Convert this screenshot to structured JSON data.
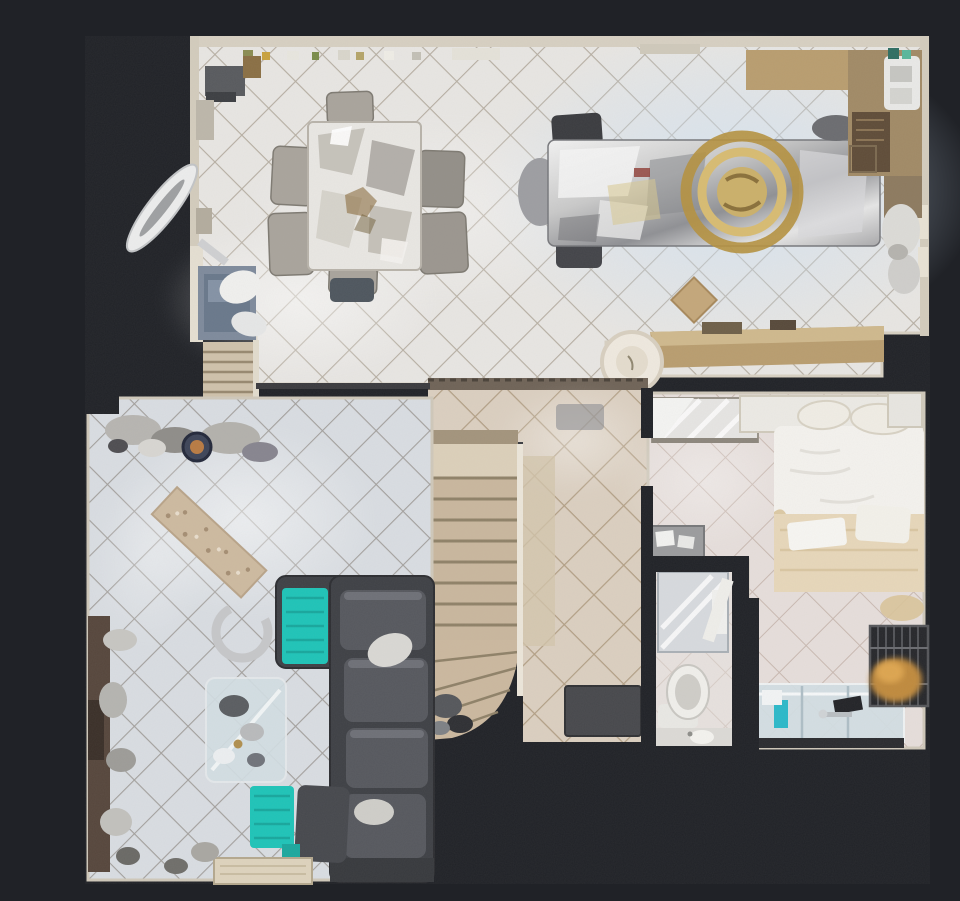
{
  "app": {
    "name": "3d-tour-floorplan-viewer",
    "view": "top-down dollhouse floor plan",
    "floor": "main level"
  },
  "palette": {
    "background": "#202227",
    "wall_beige": "#d7d0c2",
    "tile_kitchen": "#e8e6e3",
    "tile_living": "#d9dde2",
    "tile_hall": "#dbcfc0",
    "tile_bedroom": "#e6dedb",
    "stair_carpet": "#c9b79e",
    "teal_blanket": "#1ec4b8",
    "sofa_dark": "#3e4045",
    "gold_chandelier": "#b5913f",
    "counter_tan": "#b99d6f",
    "cabinet_brown": "#a18a66",
    "entry_rug_blue": "#7e8a9c",
    "mosaic_runner": "#cdbaa0",
    "door_mat": "#47484c",
    "bed_white": "#f4f2ee",
    "bed_blanket_tan": "#e7d7ba",
    "glass_counter": "#d3dfe4",
    "dog_golden": "#c08a3e",
    "metal_silver": "#c9c9c9"
  },
  "rooms": [
    {
      "id": "dining",
      "name": "Dining area"
    },
    {
      "id": "kitchen",
      "name": "Kitchen"
    },
    {
      "id": "entry",
      "name": "Entry / foyer"
    },
    {
      "id": "living",
      "name": "Living room"
    },
    {
      "id": "hallway",
      "name": "Hallway"
    },
    {
      "id": "stairs",
      "name": "Staircase"
    },
    {
      "id": "bedroom",
      "name": "Bedroom"
    },
    {
      "id": "bathroom",
      "name": "Bathroom"
    },
    {
      "id": "ensuite",
      "name": "Vanity / laundry nook"
    }
  ],
  "furniture": [
    {
      "room": "dining",
      "item": "rectangular dining table with six chairs"
    },
    {
      "room": "kitchen",
      "item": "long island table with gold chandelier above"
    },
    {
      "room": "kitchen",
      "item": "counters and sink along top-right walls"
    },
    {
      "room": "kitchen",
      "item": "breakfast-bar half wall with round table"
    },
    {
      "room": "entry",
      "item": "blue rug, ceiling-fan blades, steps down, pet bed"
    },
    {
      "room": "living",
      "item": "dark sectional sofa with two teal blankets"
    },
    {
      "room": "living",
      "item": "glass coffee table and media console"
    },
    {
      "room": "living",
      "item": "mosaic tile runner inlay"
    },
    {
      "room": "stairs",
      "item": "carpeted staircase with winder treads and rail"
    },
    {
      "room": "hallway",
      "item": "dark door mat"
    },
    {
      "room": "bedroom",
      "item": "white bed with tan blanket and pillows"
    },
    {
      "room": "bedroom",
      "item": "mirrored closet"
    },
    {
      "room": "bedroom",
      "item": "wire pet crate with golden dog"
    },
    {
      "room": "bedroom",
      "item": "glass-top dresser with teal bottle"
    },
    {
      "room": "bathroom",
      "item": "shower, toilet and sink"
    }
  ]
}
